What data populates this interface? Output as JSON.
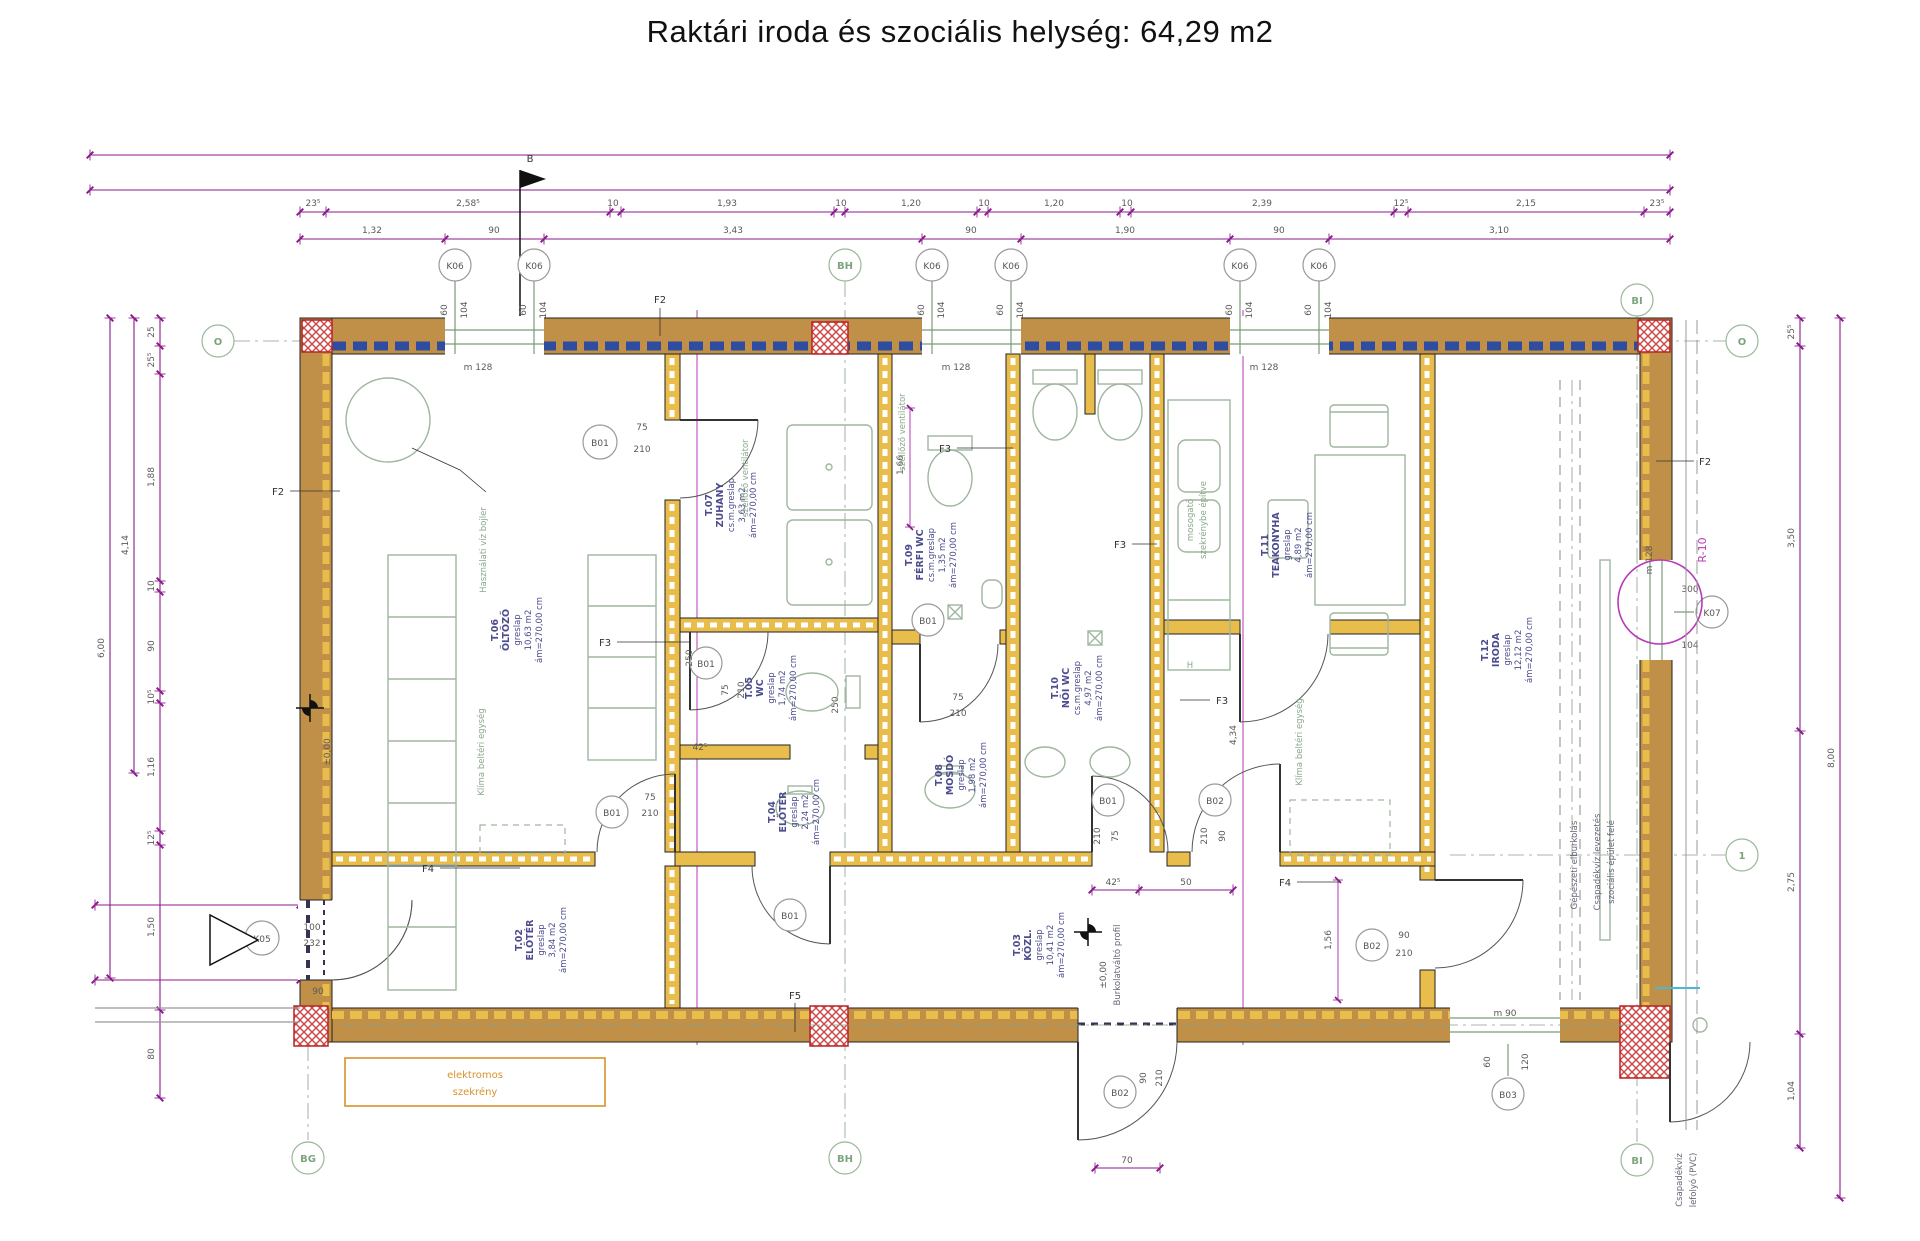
{
  "title": "Raktári iroda és szociális helység: 64,29 m2",
  "dims": {
    "t1": [
      "23⁵",
      "2,58⁵",
      "10",
      "1,93",
      "10",
      "1,20",
      "10",
      "1,20",
      "10",
      "2,39",
      "12⁵",
      "2,15",
      "23⁵"
    ],
    "t2": [
      "1,32",
      "90",
      "3,43",
      "90",
      "1,90",
      "90",
      "3,10"
    ],
    "left": [
      "25",
      "25⁵",
      "1,88",
      "10",
      "90",
      "10⁵",
      "1,16",
      "12⁵",
      "1,50",
      "80"
    ],
    "left_outer": [
      "4,14",
      "6,00"
    ],
    "right": [
      "25⁵",
      "3,50",
      "2,75",
      "1,04"
    ],
    "right_outer": [
      "8,00"
    ],
    "misc": {
      "d42": "42⁵",
      "d50": "50",
      "d70": "70",
      "d250": "250",
      "d156": "1,56",
      "d166": "1,66",
      "d434": "4,34"
    }
  },
  "grid": {
    "b": "B",
    "bg": "BG",
    "bh": "BH",
    "bi": "BI",
    "o": "O",
    "one": "1"
  },
  "openings": {
    "k06": {
      "id": "K06",
      "w": "60",
      "h": "104",
      "sill": "m 128"
    },
    "k07": {
      "id": "K07",
      "w": "300",
      "h": "104"
    },
    "k05": {
      "id": "K05",
      "w": "100",
      "h": "232",
      "extra": "90"
    },
    "b01": {
      "id": "B01",
      "w": "75",
      "h": "210"
    },
    "b02": {
      "id": "B02",
      "w": "90",
      "h": "210"
    },
    "b03": {
      "id": "B03",
      "w": "60",
      "h": "120",
      "sill": "m 90"
    }
  },
  "rooms": [
    {
      "id": "T.06",
      "name": "ÖLTÖZŐ",
      "finish": "greslap",
      "area": "10,63 m2",
      "height": "ám=270,00 cm"
    },
    {
      "id": "T.07",
      "name": "ZUHANY",
      "finish": "cs.m.greslap",
      "area": "3,63 m2",
      "height": "ám=270,00 cm"
    },
    {
      "id": "T.05",
      "name": "WC",
      "finish": "greslap",
      "area": "1,74 m2",
      "height": "ám=270,00 cm"
    },
    {
      "id": "T.04",
      "name": "ELŐTÉR",
      "finish": "greslap",
      "area": "2,24 m2",
      "height": "ám=270,00 cm"
    },
    {
      "id": "T.09",
      "name": "FÉRFI WC",
      "finish": "cs.m.greslap",
      "area": "1,35 m2",
      "height": "ám=270,00 cm"
    },
    {
      "id": "T.08",
      "name": "MOSDÓ",
      "finish": "greslap",
      "area": "1,98 m2",
      "height": "ám=270,00 cm"
    },
    {
      "id": "T.10",
      "name": "NŐI WC",
      "finish": "cs.m.greslap",
      "area": "4,97 m2",
      "height": "ám=270,00 cm"
    },
    {
      "id": "T.11",
      "name": "TEAKONYHA",
      "finish": "greslap",
      "area": "4,89 m2",
      "height": "ám=270,00 cm"
    },
    {
      "id": "T.12",
      "name": "IRODA",
      "finish": "greslap",
      "area": "12,12 m2",
      "height": "ám=270,00 cm"
    },
    {
      "id": "T.02",
      "name": "ELŐTÉR",
      "finish": "greslap",
      "area": "3,84 m2",
      "height": "ám=270,00 cm"
    },
    {
      "id": "T.03",
      "name": "KÖZL.",
      "finish": "greslap",
      "area": "10,41 m2",
      "height": "ám=270,00 cm"
    }
  ],
  "annotations": {
    "boiler": "Használati víz bojler",
    "klima": "Klíma beltéri egység",
    "szellozo": "szellőző ventilátor",
    "elektromos1": "elektromos",
    "elektromos2": "szekrény",
    "burkolat": "Burkolatváltó profil",
    "csapadek1": "Csapadékvíz levezetés",
    "csapadek2": "szociális épület felé",
    "gepeszeti": "Gépészeti elburkolás",
    "lefolyo1": "Csapadékvíz",
    "lefolyo2": "lefolyó (PVC)",
    "mosogato1": "mosogató",
    "mosogato2": "szekrénybe építve",
    "elevation": "±0,00",
    "r10": "R-10",
    "h_mark": "H"
  },
  "wall_types": {
    "f2": "F2",
    "f3": "F3",
    "f4": "F4",
    "f5": "F5"
  }
}
